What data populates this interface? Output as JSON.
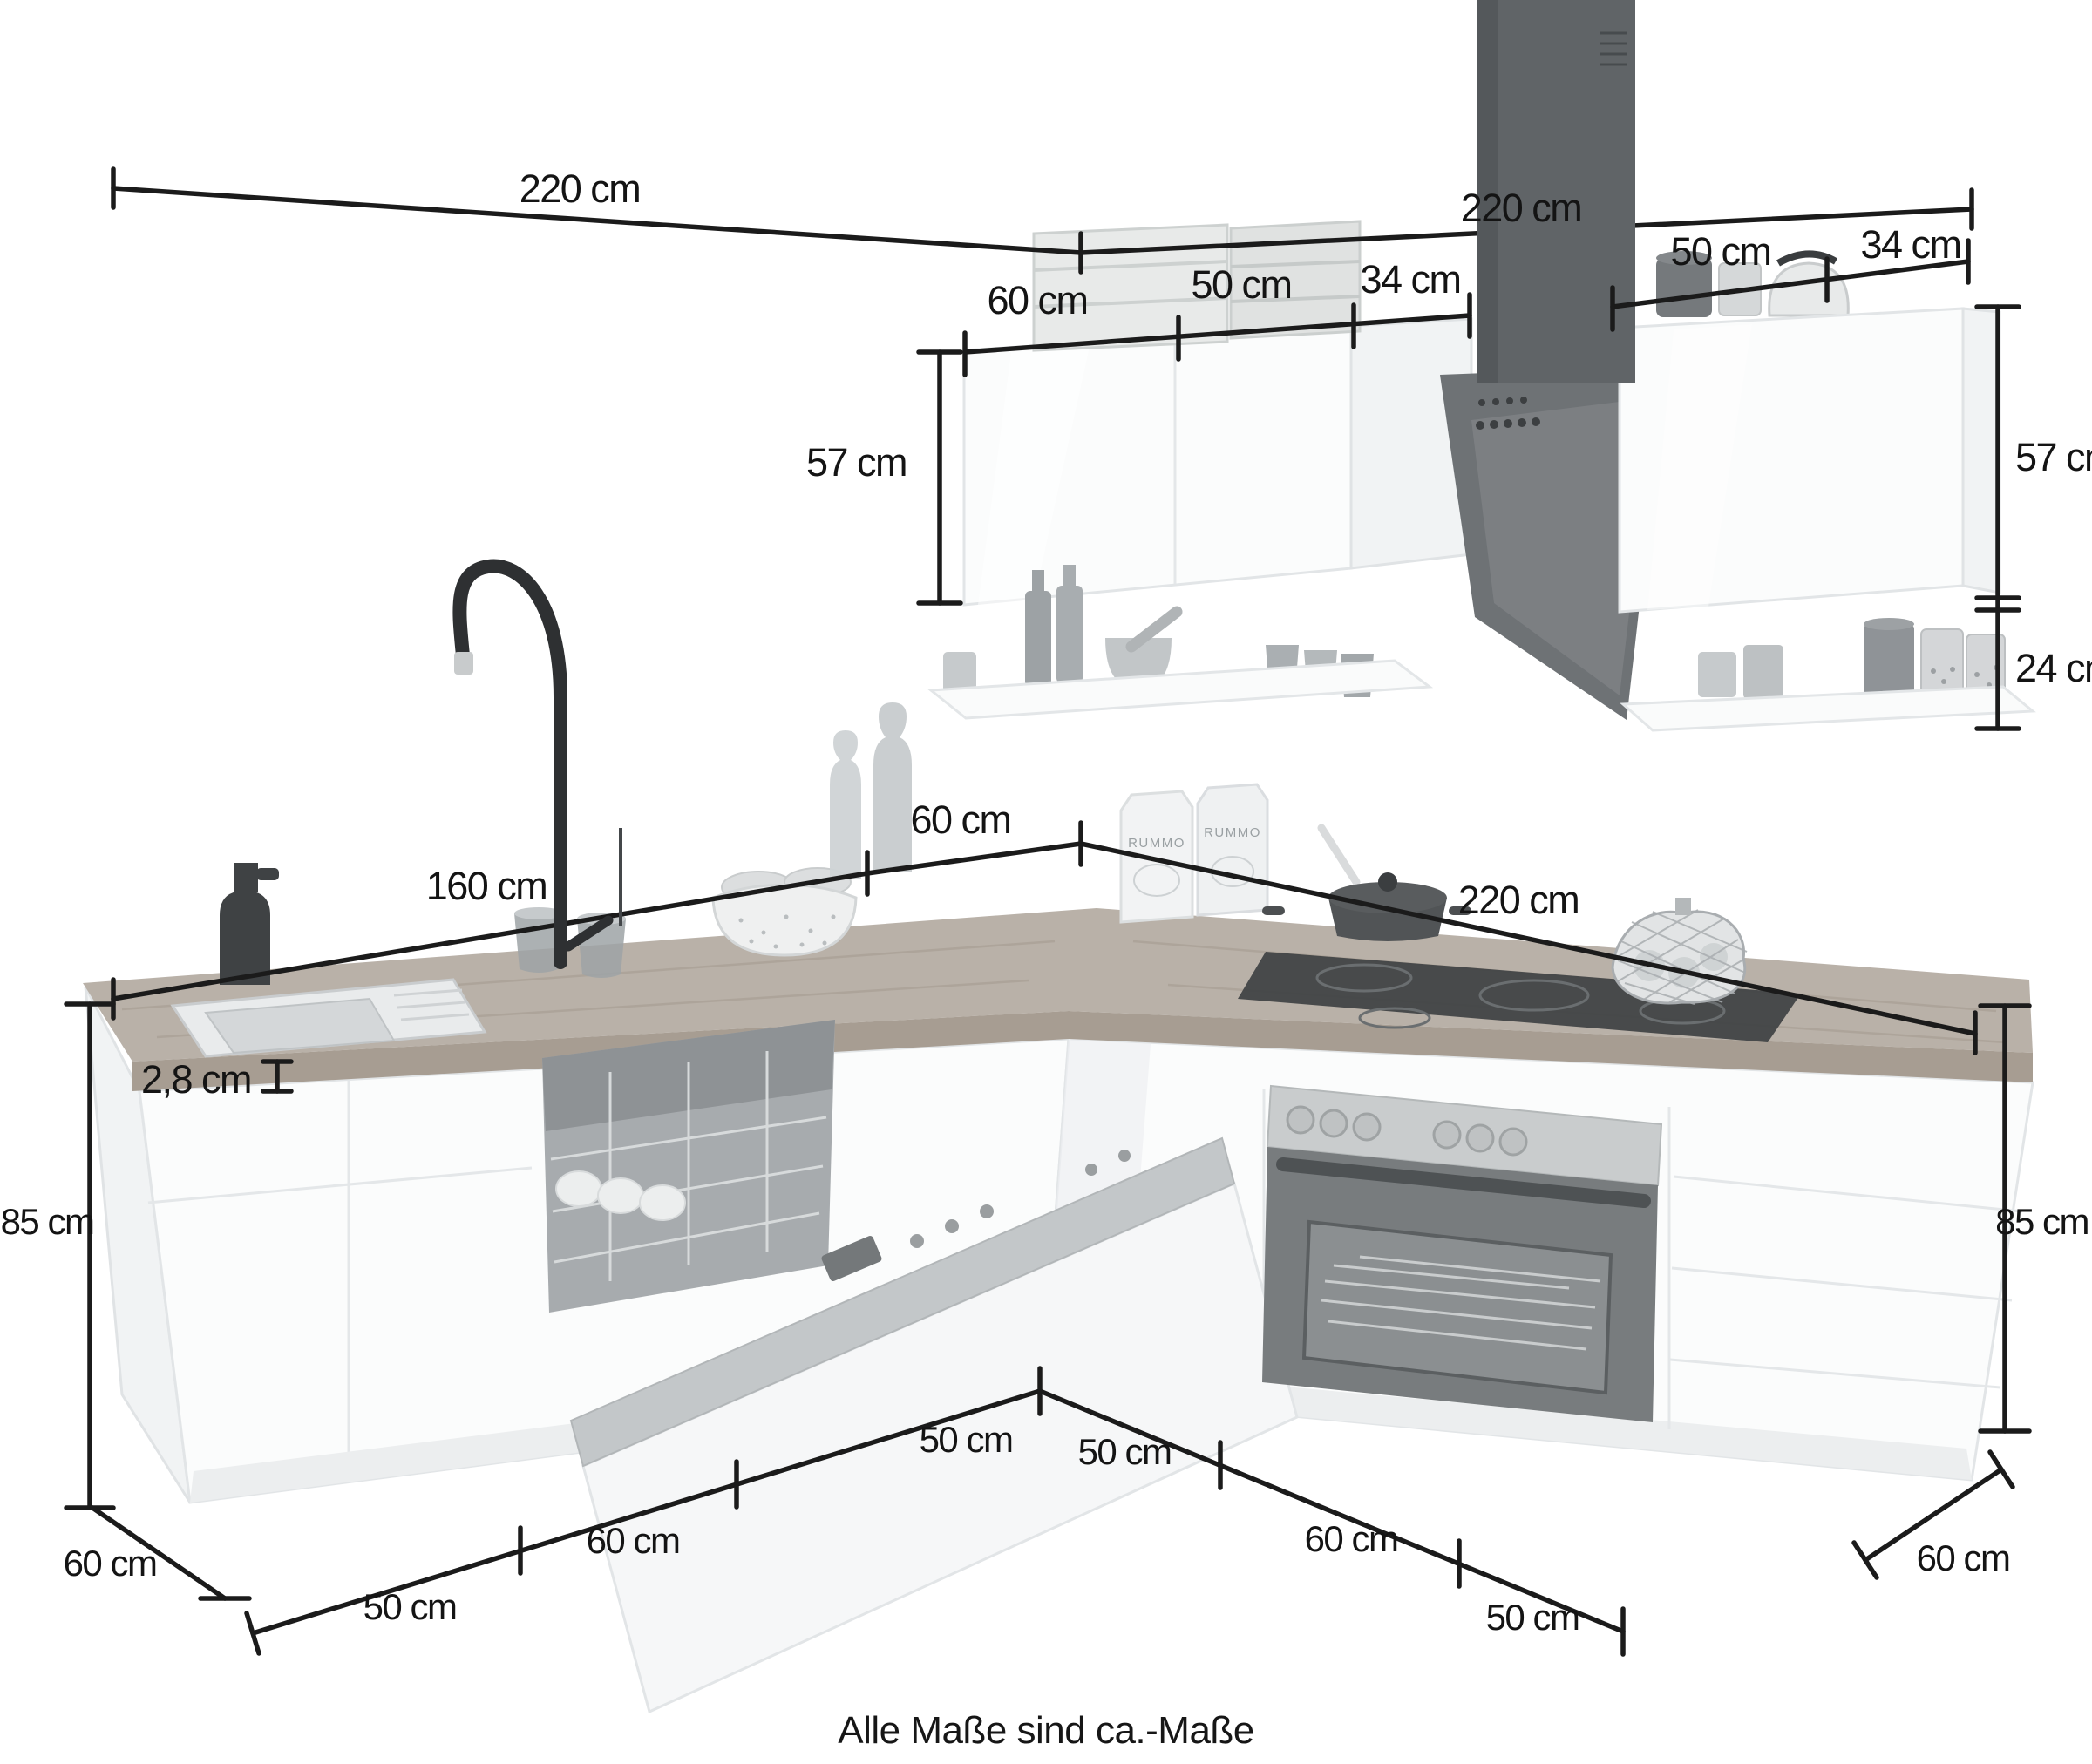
{
  "page": {
    "caption": "Alle Maße sind ca.-Maße"
  },
  "labels": {
    "top_left_width": "220 cm",
    "top_right_width": "220 cm",
    "wall_left_60": "60 cm",
    "wall_left_50": "50 cm",
    "wall_left_34": "34 cm",
    "wall_right_50": "50 cm",
    "wall_right_34": "34 cm",
    "wall_left_height": "57 cm",
    "wall_right_height": "57 cm",
    "shelf_right_height": "24 cm",
    "counter_left_160": "160 cm",
    "counter_corner_60": "60 cm",
    "counter_right_220": "220 cm",
    "worktop_thickness": "2,8 cm",
    "height_left_85": "85 cm",
    "height_right_85": "85 cm",
    "depth_left_60": "60 cm",
    "base_left_50a": "50 cm",
    "base_left_60": "60 cm",
    "base_left_50b": "50 cm",
    "base_right_50a": "50 cm",
    "base_right_60": "60 cm",
    "base_right_50b": "50 cm",
    "depth_right_60": "60 cm",
    "pasta_brand": "RUMMO"
  },
  "colors": {
    "dimension_line": "#1b1b1b",
    "worktop": "#b9b1a8",
    "appliance_dark": "#5f6366",
    "stainless": "#c9cccd",
    "cabinet_white": "#fbfcfc"
  }
}
